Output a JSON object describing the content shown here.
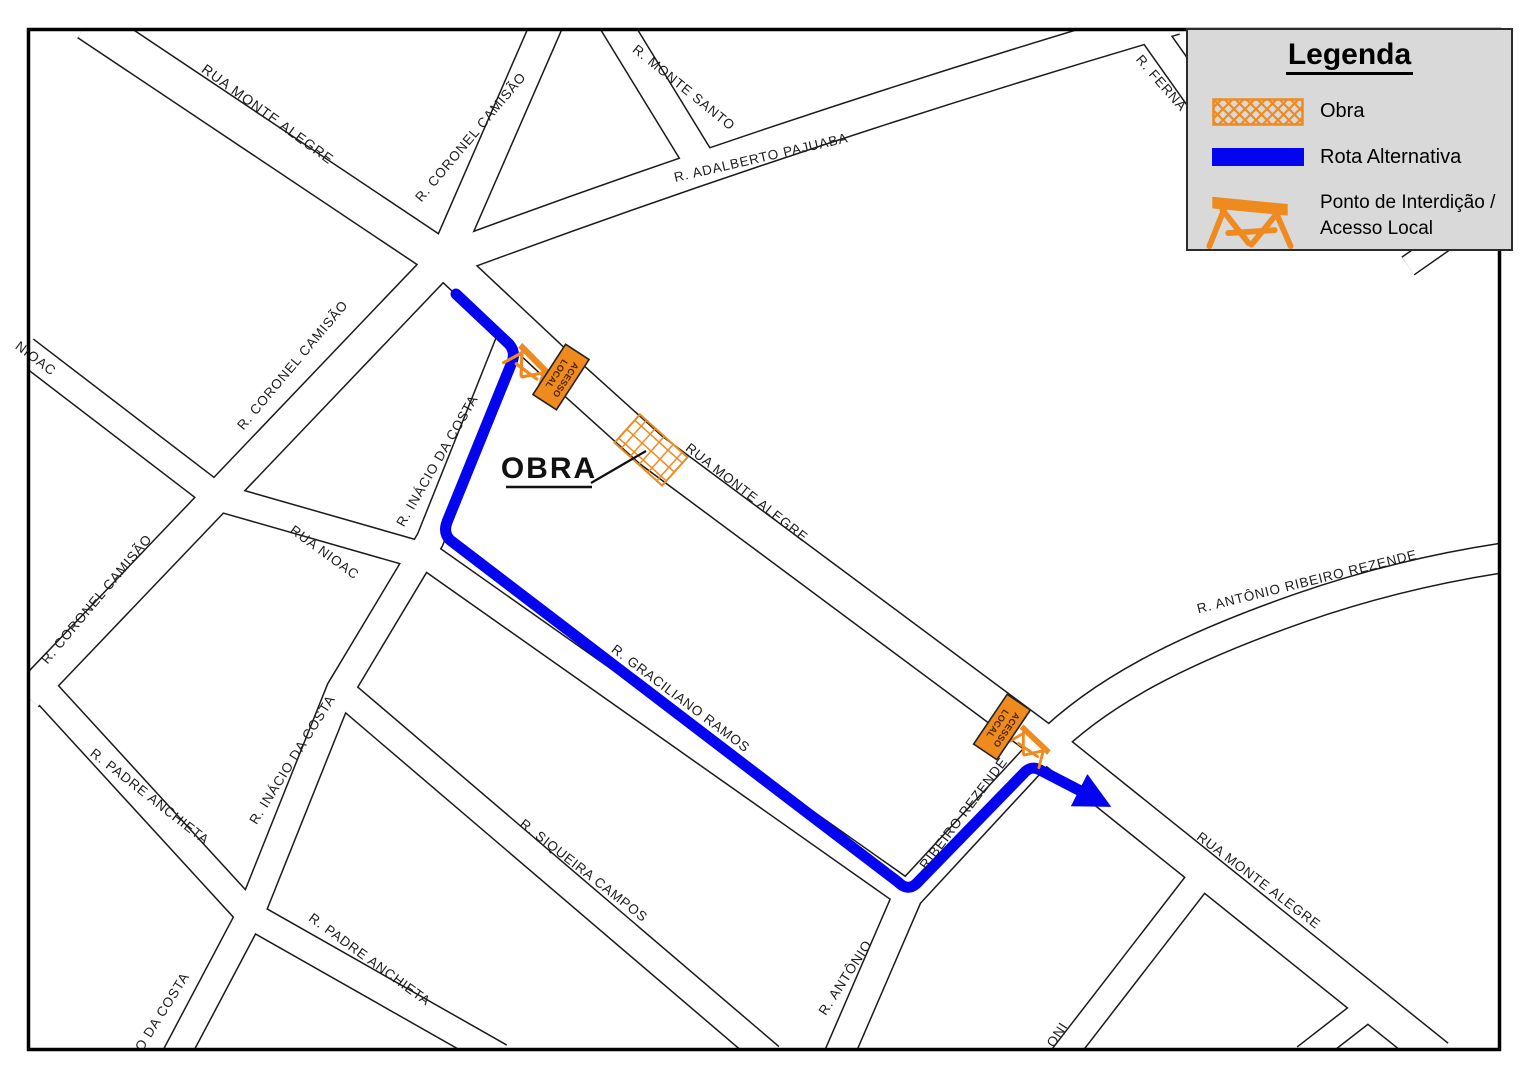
{
  "map": {
    "street_labels": [
      {
        "text": "RUA MONTE ALEGRE"
      },
      {
        "text": "R. CORONEL CAMISÃO"
      },
      {
        "text": "R. MONTE SANTO"
      },
      {
        "text": "R. ADALBERTO PAJUABA"
      },
      {
        "text": "R. FERNA"
      },
      {
        "text": "NIOAC"
      },
      {
        "text": "R. CORONEL CAMISÃO"
      },
      {
        "text": "R. INÁCIO DA COSTA"
      },
      {
        "text": "RUA NIOAC"
      },
      {
        "text": "R. CORONEL CAMISÃO"
      },
      {
        "text": "R. INÁCIO DA COSTA"
      },
      {
        "text": "R. PADRE ANCHIETA"
      },
      {
        "text": "R. PADRE ANCHIETA"
      },
      {
        "text": "O DA COSTA"
      },
      {
        "text": "RUA MONTE ALEGRE"
      },
      {
        "text": "R. GRACILIANO RAMOS"
      },
      {
        "text": "R. SIQUEIRA CAMPOS"
      },
      {
        "text": "R. ANTÔNIO"
      },
      {
        "text": "RIBEIRO REZENDE"
      },
      {
        "text": "R. ANTÔNIO RIBEIRO REZENDE"
      },
      {
        "text": "RUA MONTE ALEGRE"
      },
      {
        "text": "ONI"
      }
    ],
    "obra_callout": {
      "label": "OBRA"
    },
    "markers": [
      {
        "line1": "ACESSO",
        "line2": "LOCAL"
      },
      {
        "line1": "ACESSO",
        "line2": "LOCAL"
      }
    ]
  },
  "legend": {
    "title": "Legenda",
    "items": [
      {
        "label": "Obra"
      },
      {
        "label": "Rota Alternativa"
      },
      {
        "label_line1": "Ponto de Interdição /",
        "label_line2": "Acesso Local"
      }
    ]
  },
  "colors": {
    "construction_orange": "#EE8A1E",
    "route_blue": "#0404EE",
    "legend_bg": "#D9D9D9",
    "road_outline": "#1A1A1A"
  }
}
